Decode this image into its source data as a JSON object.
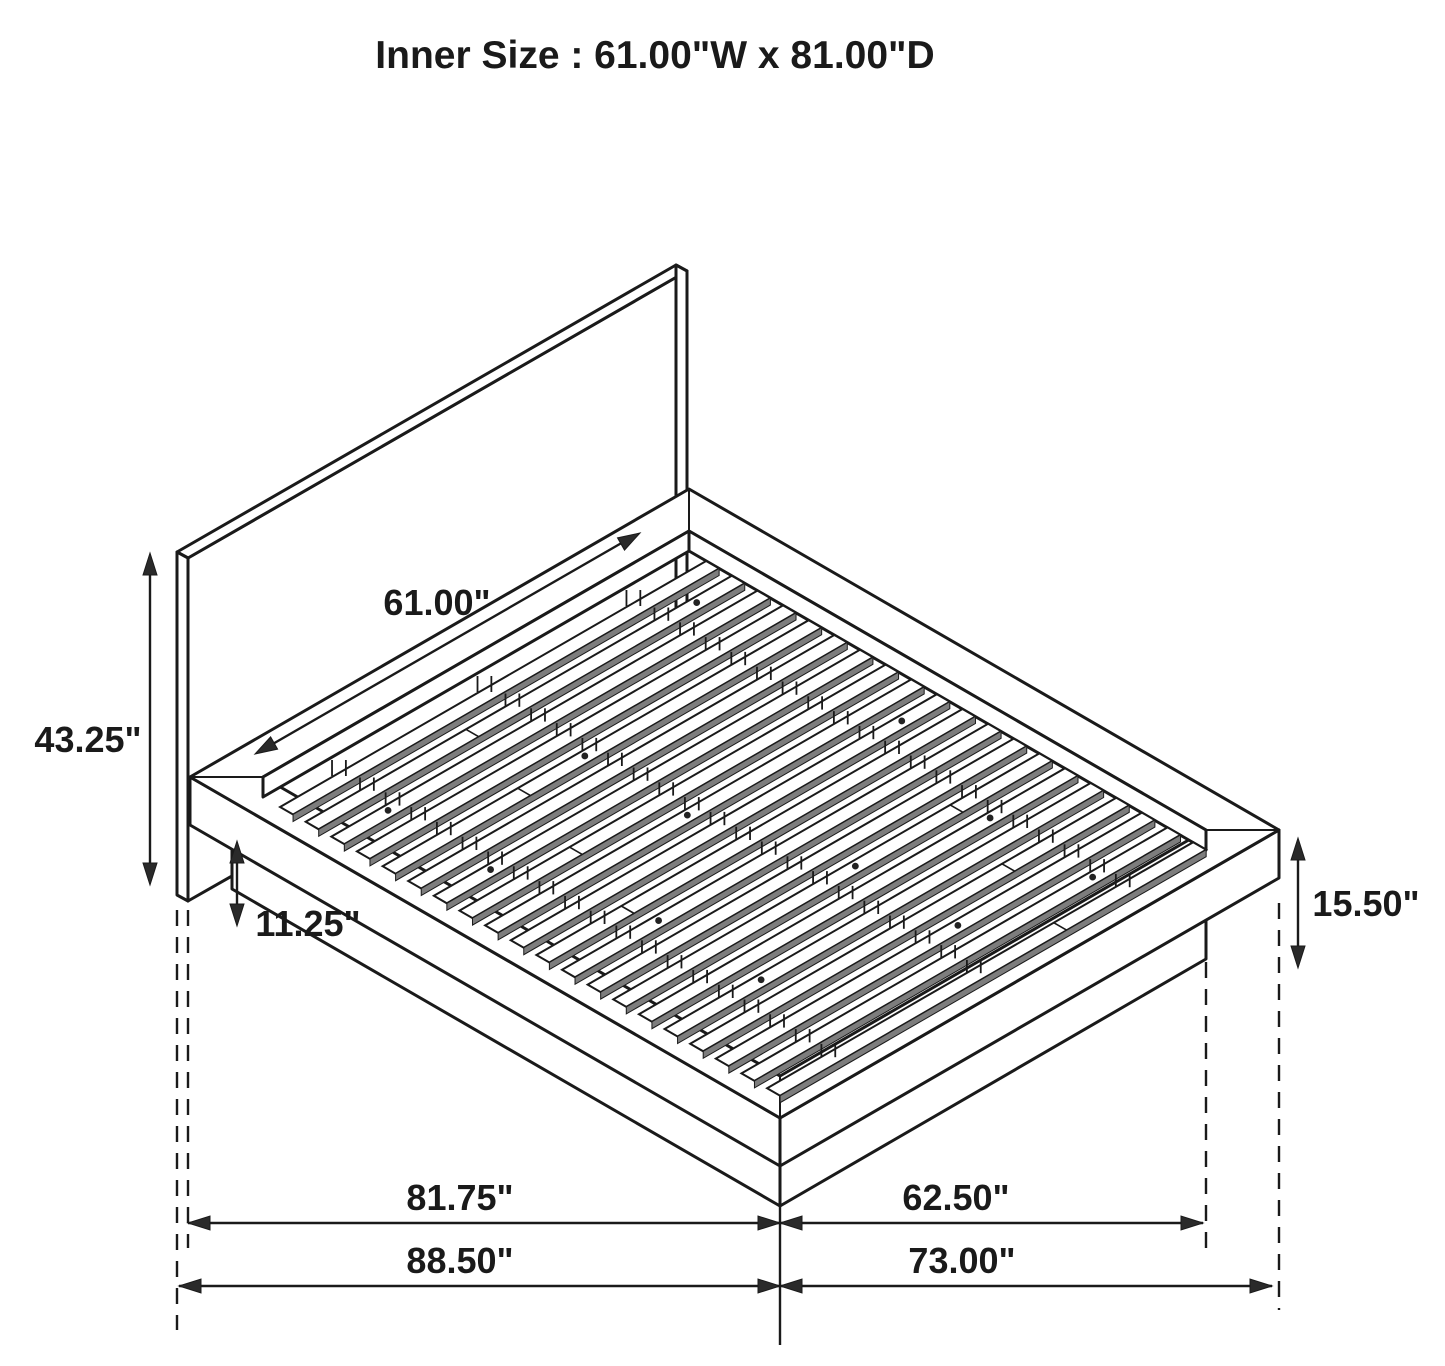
{
  "title": "Inner Size : 61.00\"W x 81.00\"D",
  "diagram": {
    "subject": "platform-bed-isometric-dimension-drawing",
    "line_color": "#1a1a1a",
    "slat_shadow_color": "#7d7d7d",
    "labels": {
      "inner_width": "61.00\"",
      "headboard_height": "43.25\"",
      "base_clearance_height": "11.25\"",
      "platform_height": "15.50\"",
      "platform_length": "81.75\"",
      "platform_width": "62.50\"",
      "overall_length": "88.50\"",
      "overall_width": "73.00\""
    }
  }
}
